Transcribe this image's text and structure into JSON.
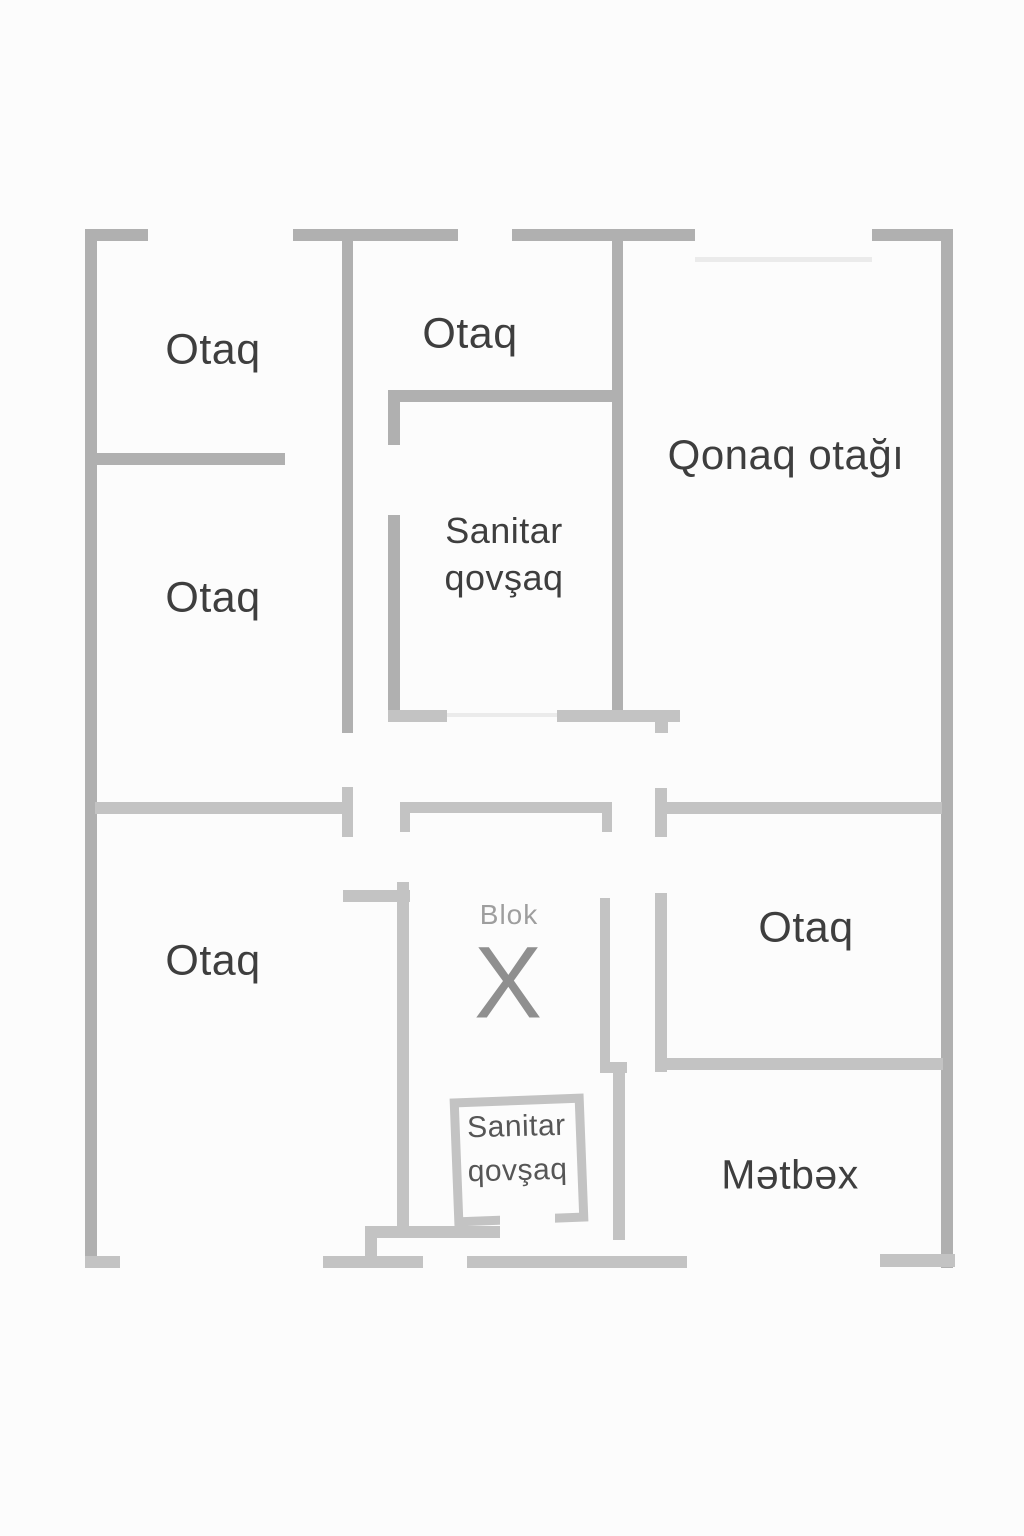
{
  "floorplan": {
    "background_color": "#fcfcfc",
    "wall_color": "#b0b0b0",
    "wall_light_color": "#c3c3c3",
    "label_color": "#3e3e3e",
    "muted_label_color": "#9e9e9e",
    "rooms": [
      {
        "id": "otaq-top-left",
        "label": "Otaq"
      },
      {
        "id": "otaq-top-middle",
        "label": "Otaq"
      },
      {
        "id": "qonaq-otagi",
        "label": "Qonaq otağı"
      },
      {
        "id": "otaq-middle-left",
        "label": "Otaq"
      },
      {
        "id": "sanitar-qovsaq-upper",
        "label_line1": "Sanitar",
        "label_line2": "qovşaq"
      },
      {
        "id": "otaq-bottom-left",
        "label": "Otaq"
      },
      {
        "id": "blok-x",
        "label": "Blok",
        "symbol": "X"
      },
      {
        "id": "otaq-right",
        "label": "Otaq"
      },
      {
        "id": "sanitar-qovsaq-lower",
        "label_line1": "Sanitar",
        "label_line2": "qovşaq"
      },
      {
        "id": "metbex",
        "label": "Mətbəx"
      }
    ]
  }
}
